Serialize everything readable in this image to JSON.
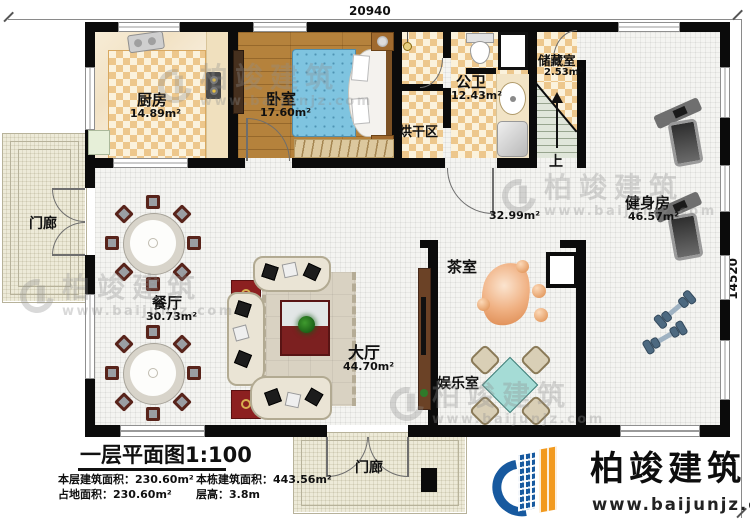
{
  "dimensions": {
    "top": "20940",
    "right": "14520"
  },
  "rooms": {
    "kitchen": {
      "name": "厨房",
      "area": "14.89m²"
    },
    "bedroom": {
      "name": "卧室",
      "area": "17.60m²"
    },
    "bath": {
      "name": "公卫",
      "area": "12.43m²"
    },
    "drying": {
      "name": "烘干区"
    },
    "storage": {
      "name": "储藏室",
      "area": "2.53m²"
    },
    "gym": {
      "name": "健身房",
      "area": "46.57m²"
    },
    "corridor": {
      "area": "32.99m²"
    },
    "dining": {
      "name": "餐厅",
      "area": "30.73m²"
    },
    "hall": {
      "name": "大厅",
      "area": "44.70m²"
    },
    "tea": {
      "name": "茶室"
    },
    "entertainment": {
      "name": "娱乐室"
    },
    "porch_left": {
      "name": "门廊"
    },
    "porch_bottom": {
      "name": "门廊"
    }
  },
  "stairs": {
    "up_label": "上"
  },
  "title_block": {
    "title": "一层平面图1:100",
    "floor_area": "本层建筑面积：230.60m²",
    "total_area": "本栋建筑面积：443.56m²",
    "footprint": "占地面积：230.60m²",
    "floor_height": "层高：3.8m"
  },
  "logo": {
    "company": "柏竣建筑",
    "website": "www.baijunjz.com"
  },
  "watermark": {
    "company": "柏竣建筑",
    "website": "www.baijunjz.com"
  },
  "colors": {
    "wall": "#0b0b0b",
    "checker_tile": "#edc78c",
    "wood": "#b5823c",
    "logo_blue": "#17599f",
    "logo_orange": "#f29a1f"
  }
}
